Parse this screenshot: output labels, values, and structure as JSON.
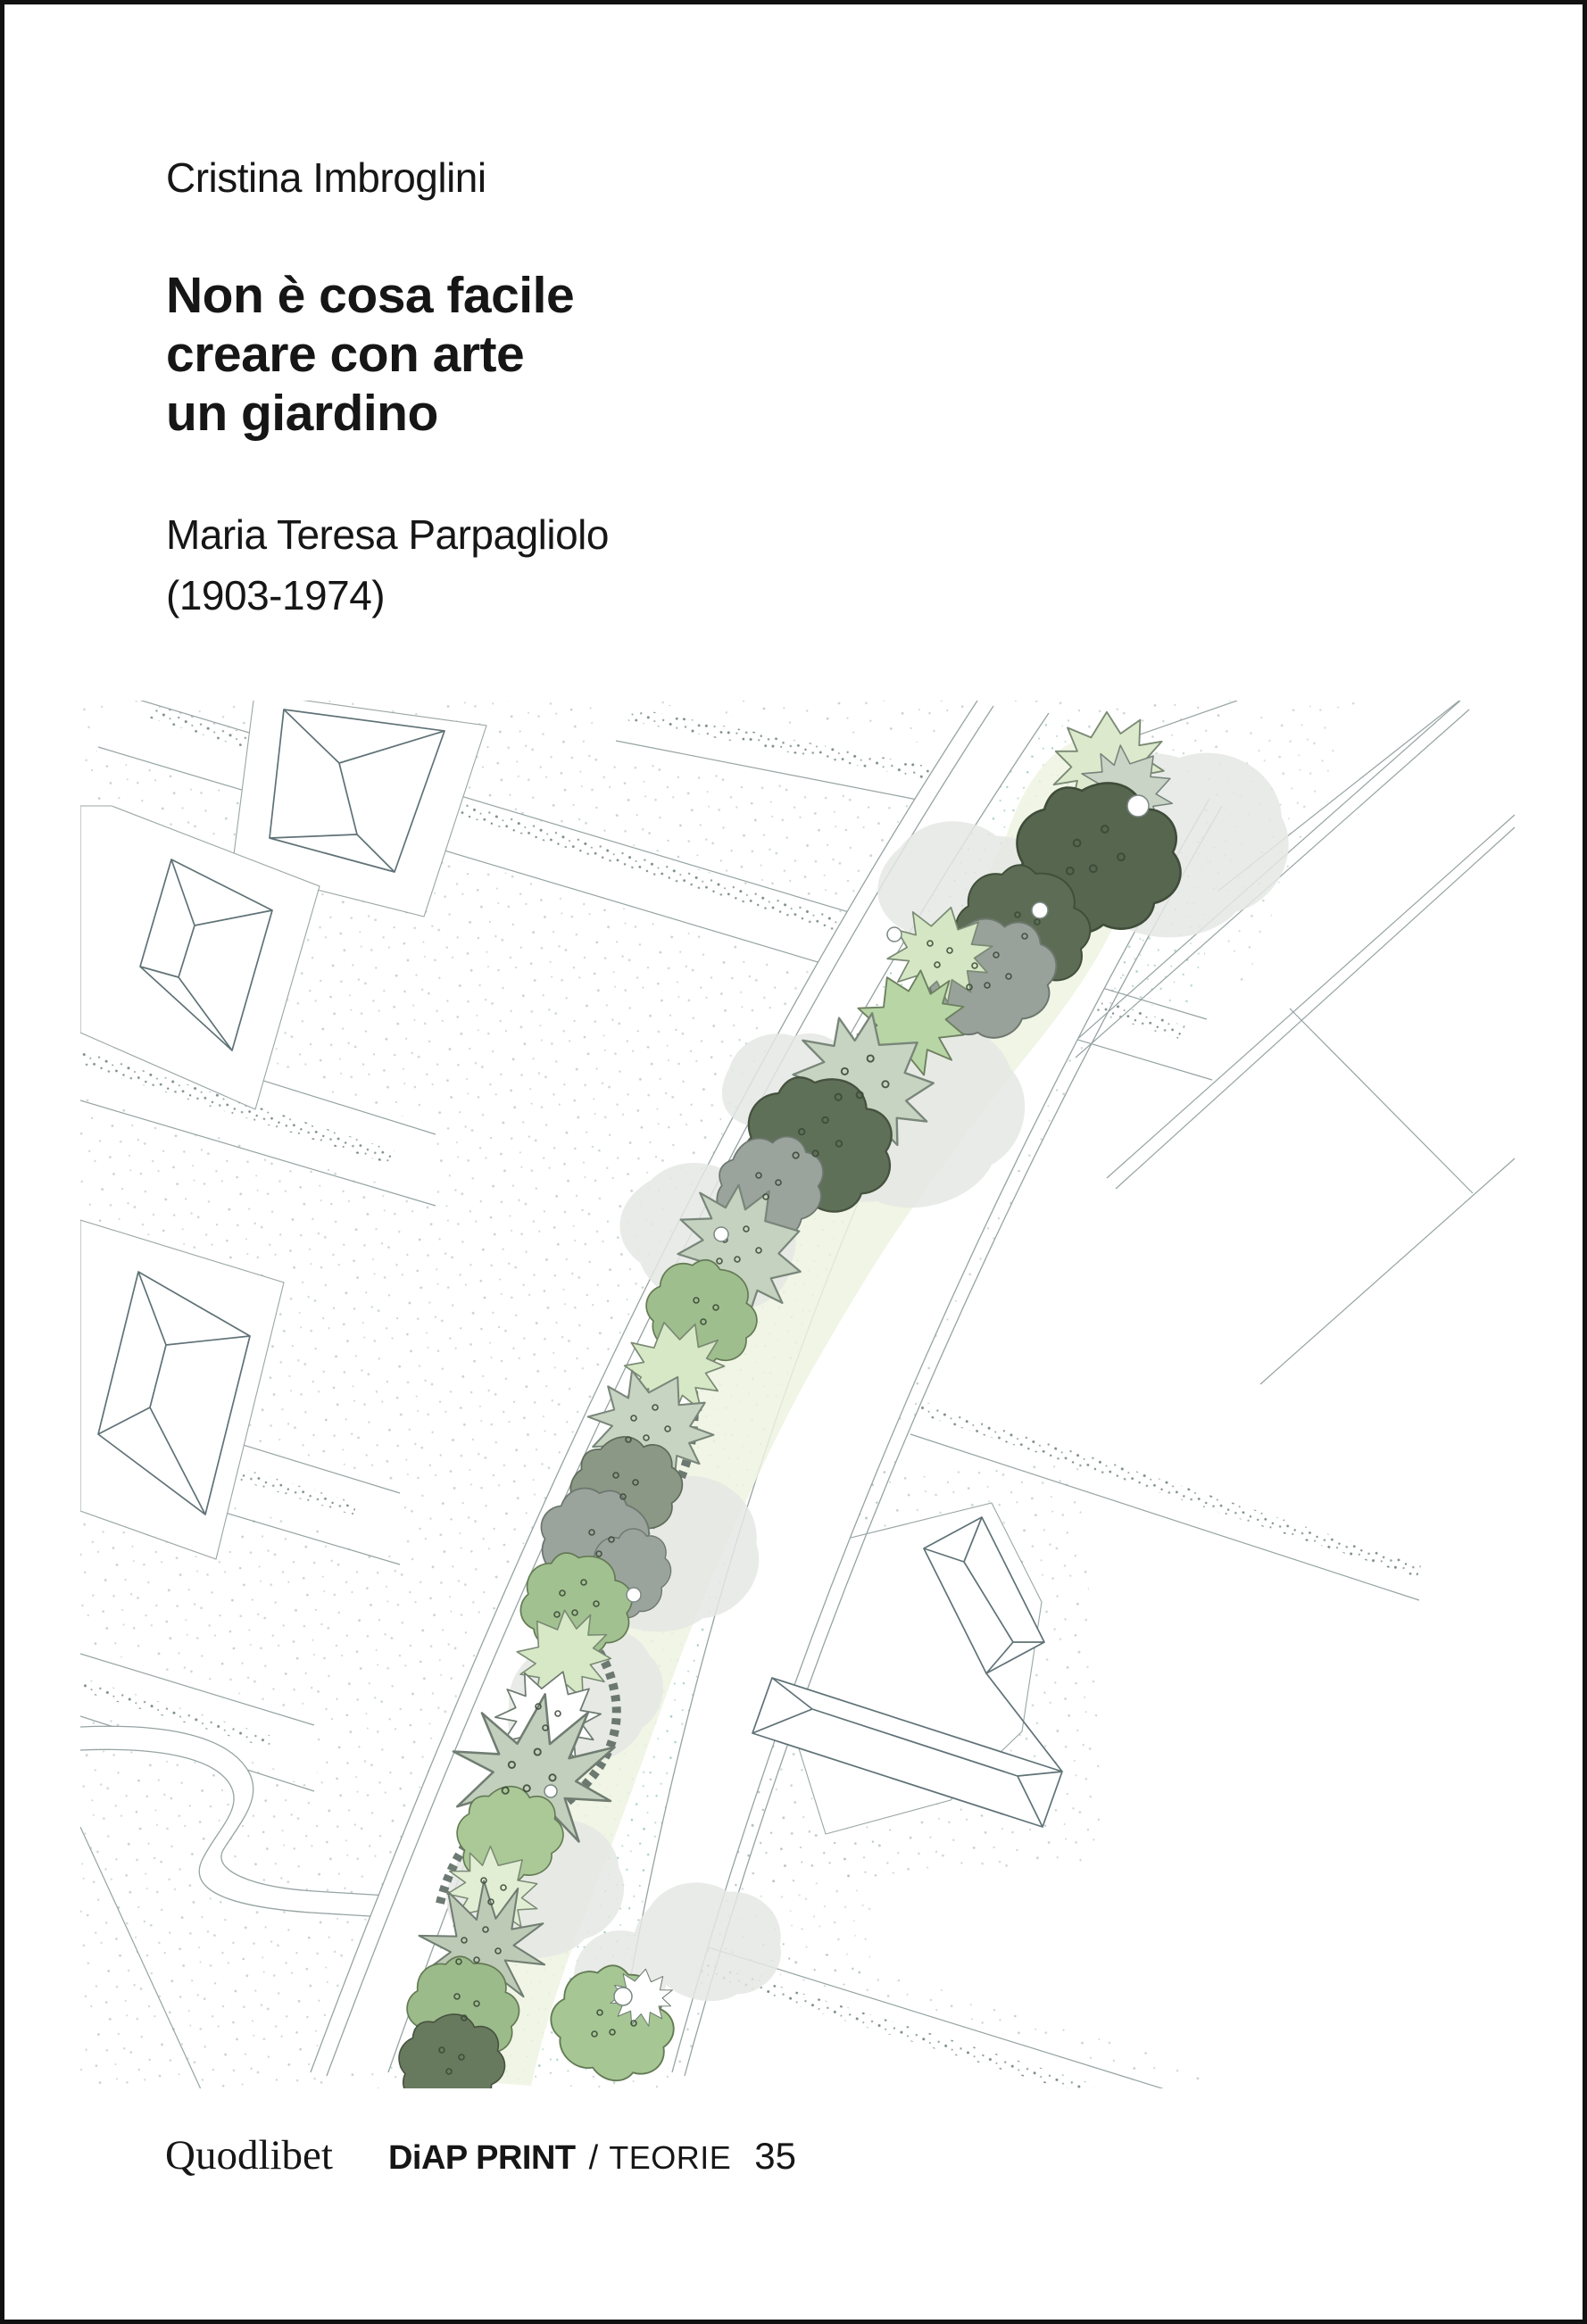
{
  "cover": {
    "author": "Cristina Imbroglini",
    "title_lines": [
      "Non è cosa facile",
      "creare con arte",
      "un giardino"
    ],
    "subtitle_lines": [
      "Maria Teresa Parpagliolo",
      "(1903-1974)"
    ],
    "colophon": {
      "publisher": "Quodlibet",
      "imprint": "DiAP PRINT",
      "separator": "/",
      "series": "TEORIE",
      "series_number": "35"
    }
  },
  "illustration": {
    "description": "Landscape-architecture site plan: a curving road with a planted median of trees and shrubs, hipped-roof building outlines, stippled parcels and gravel paths",
    "palette": {
      "ink": "#161616",
      "boundary_line": "#97a3a3",
      "building_line": "#5f7276",
      "stipple_gray": "#9fb0ae",
      "stipple_teal": "#8fc4b6",
      "shadow_gray": "#e5e8e4",
      "pale_green": "#edf3e0",
      "light_green": "#d7e8c6",
      "grass_green": "#b8d5a5",
      "sage_green": "#c8d4c2",
      "mid_green": "#9fbe8d",
      "dark_green": "#5d6b5a",
      "gray_green": "#9aa49d"
    }
  }
}
